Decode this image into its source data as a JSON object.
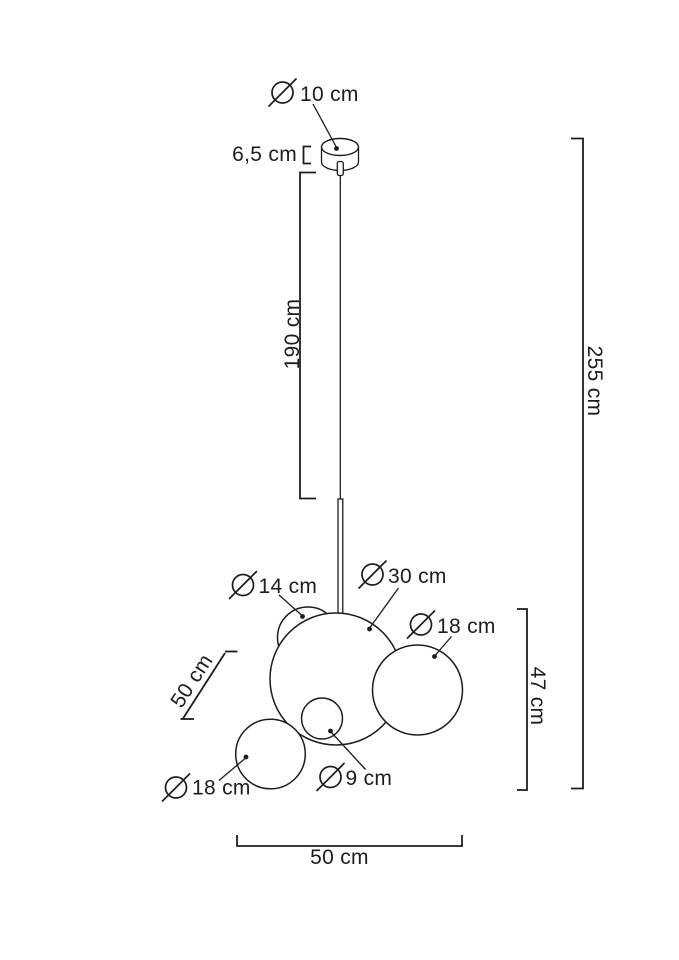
{
  "page": {
    "background": "#ffffff",
    "line_color": "#1d1d1d"
  },
  "drawing": {
    "type": "technical-dimension-diagram",
    "subject": "bubble glass pendant lamp with ceiling canopy, suspension cable and five spheres",
    "diameter_symbol": "Ø",
    "dimensions": {
      "canopy_diameter": "10 cm",
      "canopy_height": "6,5 cm",
      "cable_length": "190 cm",
      "total_height": "255 cm",
      "top_small_sphere_diameter": "14 cm",
      "large_sphere_diameter": "30 cm",
      "right_sphere_diameter": "18 cm",
      "cluster_height": "47 cm",
      "cluster_depth": "50 cm",
      "center_small_sphere_diameter": "9 cm",
      "bottom_left_sphere_diameter": "18 cm",
      "cluster_width": "50 cm"
    }
  }
}
